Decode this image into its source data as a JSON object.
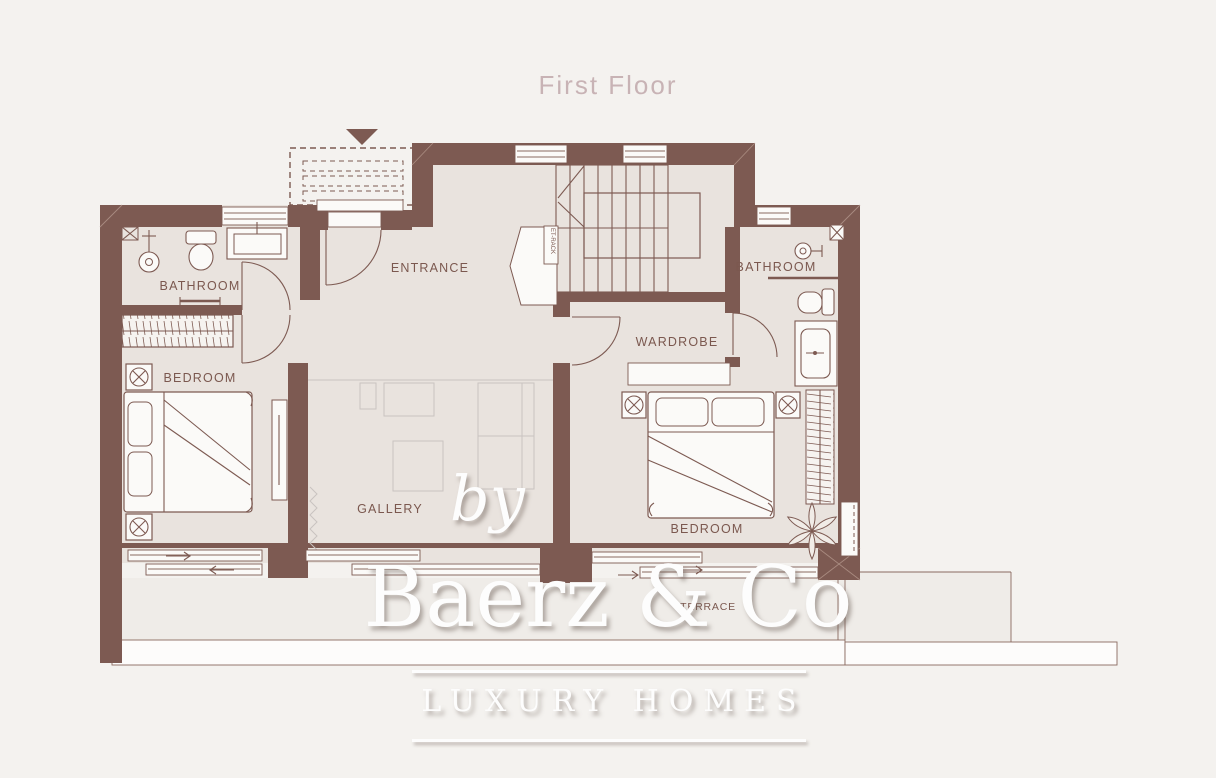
{
  "title": "First Floor",
  "plan": {
    "labels": {
      "bathroom_left": "BATHROOM",
      "bedroom_left": "BEDROOM",
      "entrance": "ENTRANCE",
      "et_rack": "ET-RACK",
      "wardrobe": "WARDROBE",
      "bathroom_right": "BATHROOM",
      "gallery": "GALLERY",
      "bedroom_right": "BEDROOM",
      "terrace": "TERRACE"
    },
    "icons": {
      "entrance_marker": "triangle-down-icon",
      "stairs": "stairs-icon",
      "bed": "double-bed-icon",
      "lamp": "lamp-circle-x-icon",
      "plant": "plant-icon",
      "shower": "shower-icon",
      "toilet": "toilet-icon",
      "sink": "sink-vanity-icon",
      "shower_tray": "shower-tray-icon",
      "wardrobe_hatch": "wardrobe-hatch-icon"
    }
  },
  "watermark": {
    "prefix": "by",
    "brand": "Baerz & Co",
    "tagline": "LUXURY HOMES"
  },
  "colors": {
    "background": "#f4f2ef",
    "floor": "#e9e3de",
    "wall": "#7d5a52",
    "label_text": "#7b584f",
    "title_text": "#c8b3b5",
    "terrace_fill": "#efece8",
    "gallery_furniture_line": "#c9c3c0",
    "watermark_text": "#fdfdfd"
  }
}
